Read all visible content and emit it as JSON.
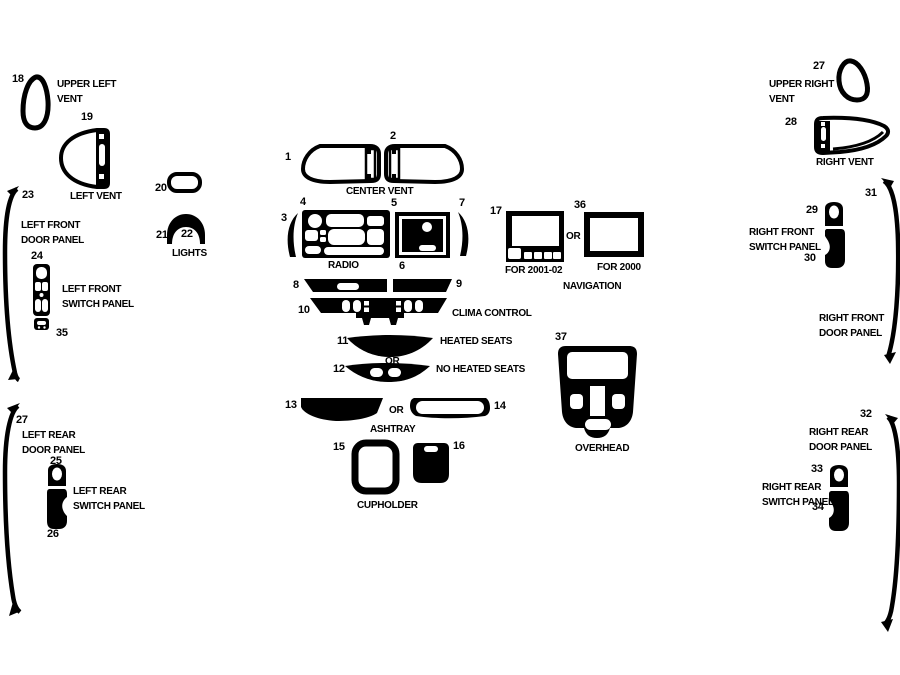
{
  "page": {
    "background": "#ffffff",
    "ink": "#000000"
  },
  "numbers": {
    "n1": "1",
    "n2": "2",
    "n3": "3",
    "n4": "4",
    "n5": "5",
    "n6": "6",
    "n7": "7",
    "n8": "8",
    "n9": "9",
    "n10": "10",
    "n11": "11",
    "n12": "12",
    "n13": "13",
    "n14": "14",
    "n15": "15",
    "n16": "16",
    "n17": "17",
    "n18": "18",
    "n19": "19",
    "n20": "20",
    "n21": "21",
    "n22": "22",
    "n23": "23",
    "n24": "24",
    "n25": "25",
    "n26": "26",
    "n27": "27",
    "n28": "28",
    "n29": "29",
    "n30": "30",
    "n31": "31",
    "n32": "32",
    "n33": "33",
    "n34": "34",
    "n35": "35",
    "n36": "36",
    "n37": "37"
  },
  "captions": {
    "upper_left_vent": "UPPER LEFT VENT",
    "left_vent": "LEFT VENT",
    "left_front_door_panel": "LEFT FRONT DOOR PANEL",
    "left_front_switch_panel": "LEFT FRONT SWITCH PANEL",
    "lights": "LIGHTS",
    "center_vent": "CENTER VENT",
    "radio": "RADIO",
    "clima_control": "CLIMA CONTROL",
    "heated_seats": "HEATED SEATS",
    "no_heated_seats": "NO HEATED SEATS",
    "ashtray": "ASHTRAY",
    "cupholder": "CUPHOLDER",
    "for_2001_02": "FOR 2001-02",
    "for_2000": "FOR 2000",
    "navigation": "NAVIGATION",
    "overhead": "OVERHEAD",
    "upper_right_vent": "UPPER RIGHT VENT",
    "right_vent": "RIGHT VENT",
    "right_front_switch_panel": "RIGHT FRONT SWITCH PANEL",
    "right_front_door_panel": "RIGHT FRONT DOOR PANEL",
    "left_rear_door_panel": "LEFT REAR DOOR PANEL",
    "left_rear_switch_panel": "LEFT REAR SWITCH PANEL",
    "right_rear_door_panel": "RIGHT REAR DOOR PANEL",
    "right_rear_switch_panel": "RIGHT REAR SWITCH PANEL",
    "or": "OR"
  }
}
